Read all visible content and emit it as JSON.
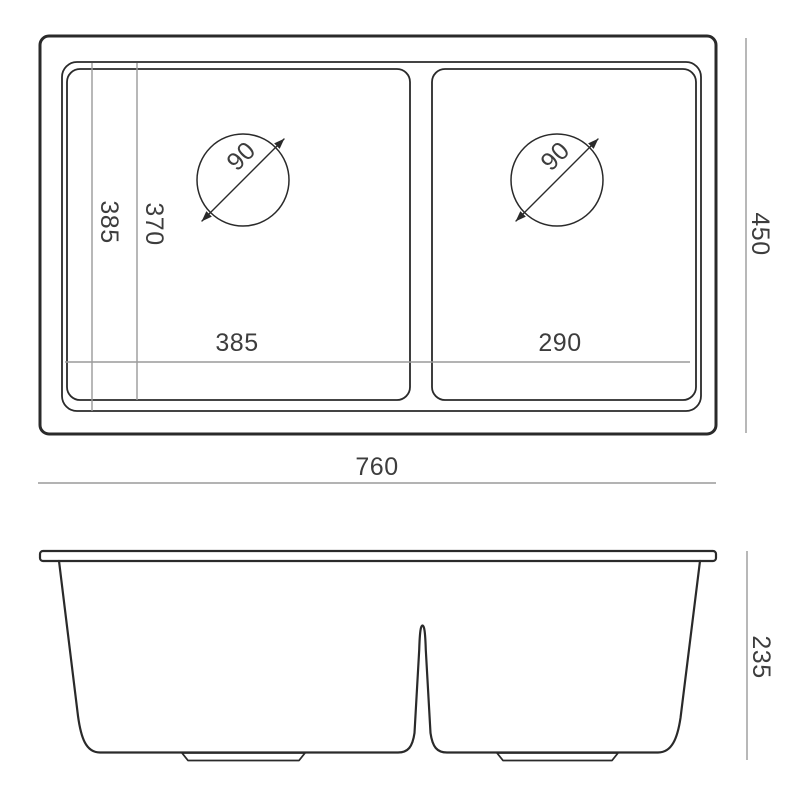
{
  "drawing_title": "Double bowl sink dimension drawing",
  "top_view": {
    "overall_width_label": "760",
    "overall_depth_label": "450",
    "left_bowl_width_label": "385",
    "right_bowl_width_label": "290",
    "left_bowl_length_label": "385",
    "inner_length_label": "370",
    "left_drain_diameter_label": "90",
    "right_drain_diameter_label": "90"
  },
  "front_view": {
    "height_label": "235"
  },
  "colors": {
    "outline": "#2a2a2a",
    "dimension_line": "#9a9a9a",
    "text": "#3d3d3d",
    "background": "#ffffff"
  }
}
